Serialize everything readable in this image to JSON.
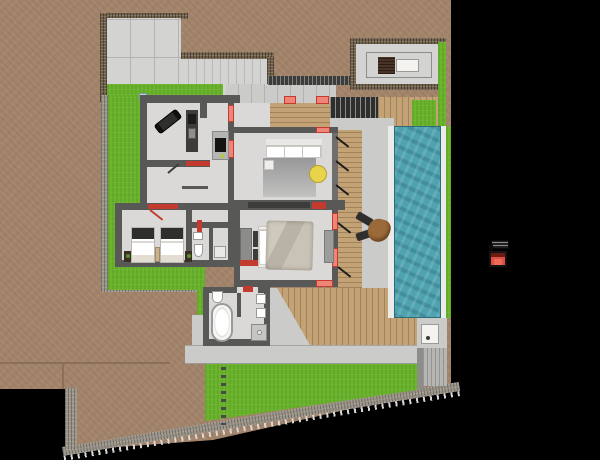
{
  "canvas": {
    "width": 600,
    "height": 460
  },
  "palette": {
    "background": "#000000",
    "terrain": "#a3846a",
    "terrainLine": "#8b7057",
    "stone": "#70604a",
    "stoneLight": "#9b9489",
    "grass": "#6ab42c",
    "concrete": "#cbcbc9",
    "concreteDark": "#b5b5b3",
    "paving": "#d3d3d1",
    "wall": "#585856",
    "wallDark": "#3c3c3a",
    "wallLight": "#8c8c8a",
    "floor": "#dad9d7",
    "wood": "#c3a276",
    "pool": "#4fa3b0",
    "poolDark": "#2e6c7a",
    "coping": "#ebebe9",
    "red": "#c23b2e",
    "salmon": "#ee8578",
    "yellow": "#e7d44c",
    "white": "#f4f3f0",
    "furnitureDark": "#2e2e2c",
    "duvet": "#c5beb2",
    "brownTable": "#9b6a3b",
    "skylightBrown": "#4a3427",
    "glassBlue": "#b9d4de"
  },
  "regions": {
    "terrain": "Earth terrain",
    "boundary_wall": "Site boundary wall",
    "driveway": "Paved driveway",
    "entry_court": "Entry courtyard",
    "pavilion": "Roof pavilion",
    "lawn": "Back lawn",
    "stepping_stones": "Stepping stone path",
    "path": "Concrete path",
    "pool": "Swimming pool",
    "patio": "Patio lounge",
    "stairs": "Exterior stairs",
    "wood_deck": "Timber deck",
    "gym": "Gym room",
    "kitchen": "Kitchen",
    "living_room": "Living room",
    "master_bedroom": "Master bedroom",
    "twin_bedroom": "Twin bedroom",
    "bathroom": "Bathroom",
    "wc": "WC",
    "material_swatch": "Selected material swatch"
  }
}
